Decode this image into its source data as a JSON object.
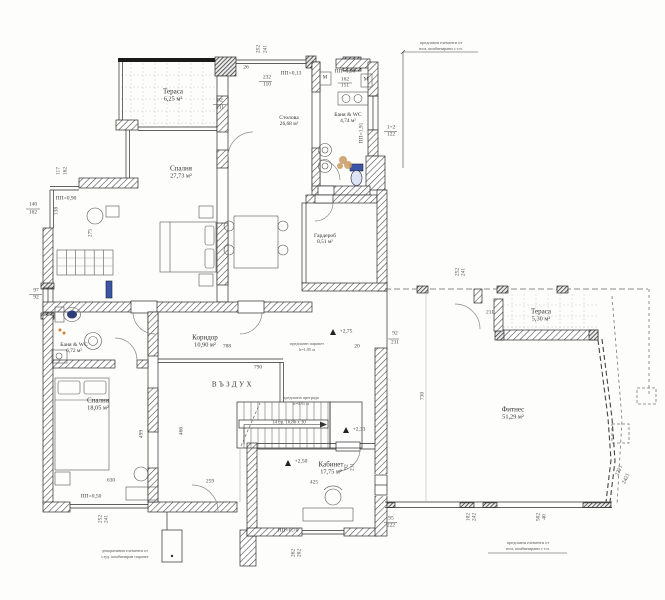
{
  "rooms": [
    {
      "name": "Тераса",
      "area": "6,25 м²"
    },
    {
      "name": "Спалня",
      "area": "27,73 м²"
    },
    {
      "name": "Столова",
      "area": "26,68 м²"
    },
    {
      "name": "Баня & WC",
      "area": "4,74 м²"
    },
    {
      "name": "Гардероб",
      "area": "8,51 м²"
    },
    {
      "name": "Баня & WC",
      "area": "6,72 м²"
    },
    {
      "name": "Спалня",
      "area": "18,05 м²"
    },
    {
      "name": "Коридор",
      "area": "10,90 м²"
    },
    {
      "name": "ВЪЗДУХ",
      "area": ""
    },
    {
      "name": "Кабинет",
      "area": "17,75 м²"
    },
    {
      "name": "Фитнес",
      "area": "51,29 м²"
    },
    {
      "name": "Тераса",
      "area": "5,30 м²"
    }
  ],
  "levels": {
    "pp013": "ПП=0,13",
    "pp190": "ПП=1,90",
    "pp191": "ПП=1,91",
    "pp090": "ПП=0,90",
    "pp050": "ПП=0,50",
    "pp070": "ПП=0,70"
  },
  "elevations": {
    "e250": "+2,50",
    "e233": "+2,33",
    "e275": "+2,75"
  },
  "stairs": {
    "label": "14 бр. 16,86 х 30"
  },
  "machine": {
    "label": "М"
  },
  "notes": {
    "top1": "предпазни елементи от",
    "top2": "юга, комбинирани с т.н.",
    "bl1": "декоративни елементи от",
    "bl2": "студ. комбиниран парапет",
    "br1": "предпазни елементи от",
    "br2": "юга, комбинирани с т.н.",
    "rail1a": "предпазен парапет",
    "rail1b": "h=1,05 м",
    "rail2a": "предпазна преграда",
    "rail2b": "h=0,95 м"
  },
  "dims": {
    "v252": "252",
    "v241": "241",
    "v232": "232",
    "v110": "110",
    "v26": "26",
    "v92": "92",
    "v211": "211",
    "v162": "162",
    "v151": "151",
    "v12": "1+2",
    "v122": "122",
    "v117": "117",
    "v140": "140",
    "v138": "138",
    "v275": "275",
    "v97": "97",
    "v630": "630",
    "v499": "499",
    "v466": "466",
    "v259": "259",
    "v788": "788",
    "v790": "790",
    "v730": "730",
    "v425": "425",
    "v20": "20",
    "v95": "95",
    "v222": "222",
    "v102": "102",
    "v242": "242",
    "v502": "502",
    "v40": "40",
    "v2221": "2221",
    "v2421": "2421",
    "v262": "262",
    "v202": "202"
  }
}
